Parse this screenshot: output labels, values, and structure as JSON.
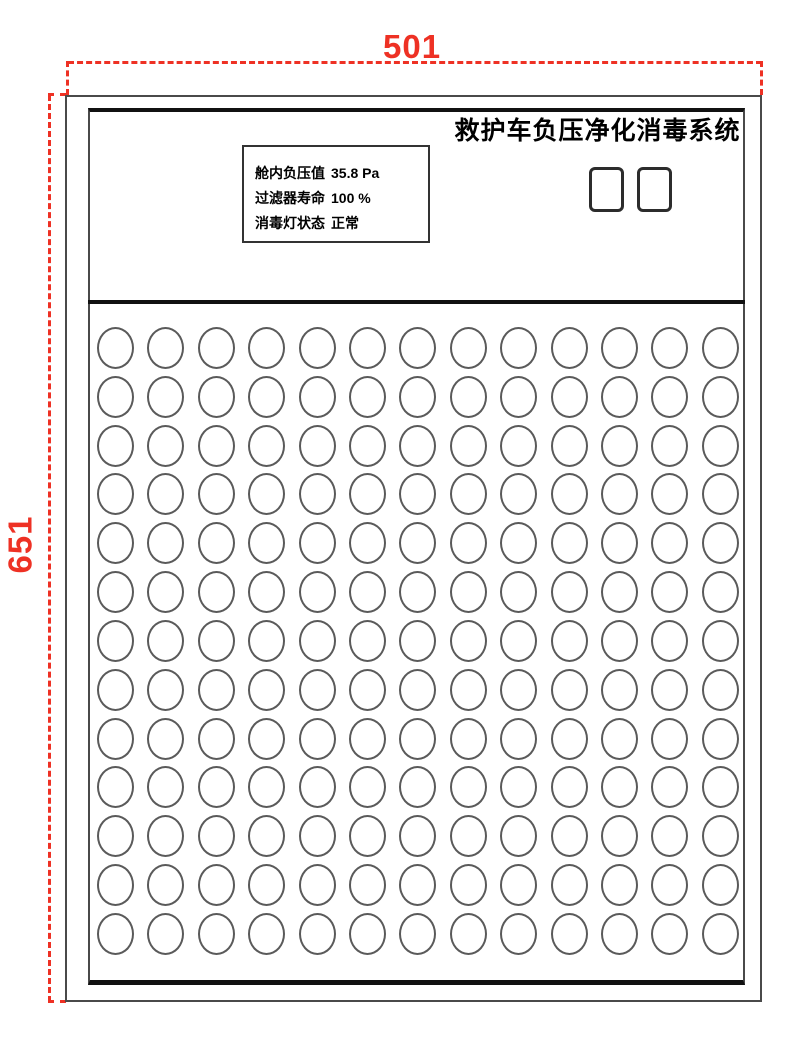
{
  "drawing": {
    "title": "救护车负压净化消毒系统",
    "dimensions": {
      "width_label": "501",
      "height_label": "651"
    },
    "status_display": {
      "lines": [
        {
          "label": "舱内负压值",
          "value": "35.8 Pa"
        },
        {
          "label": "过滤器寿命",
          "value": "100 %"
        },
        {
          "label": "消毒灯状态",
          "value": "正常"
        }
      ]
    },
    "buttons": {
      "count": 2
    },
    "hole_grid": {
      "rows": 13,
      "cols": 13
    },
    "colors": {
      "dimension_red": "#ee3124",
      "outline_gray": "#4a4a4a",
      "line_black": "#111111"
    }
  }
}
